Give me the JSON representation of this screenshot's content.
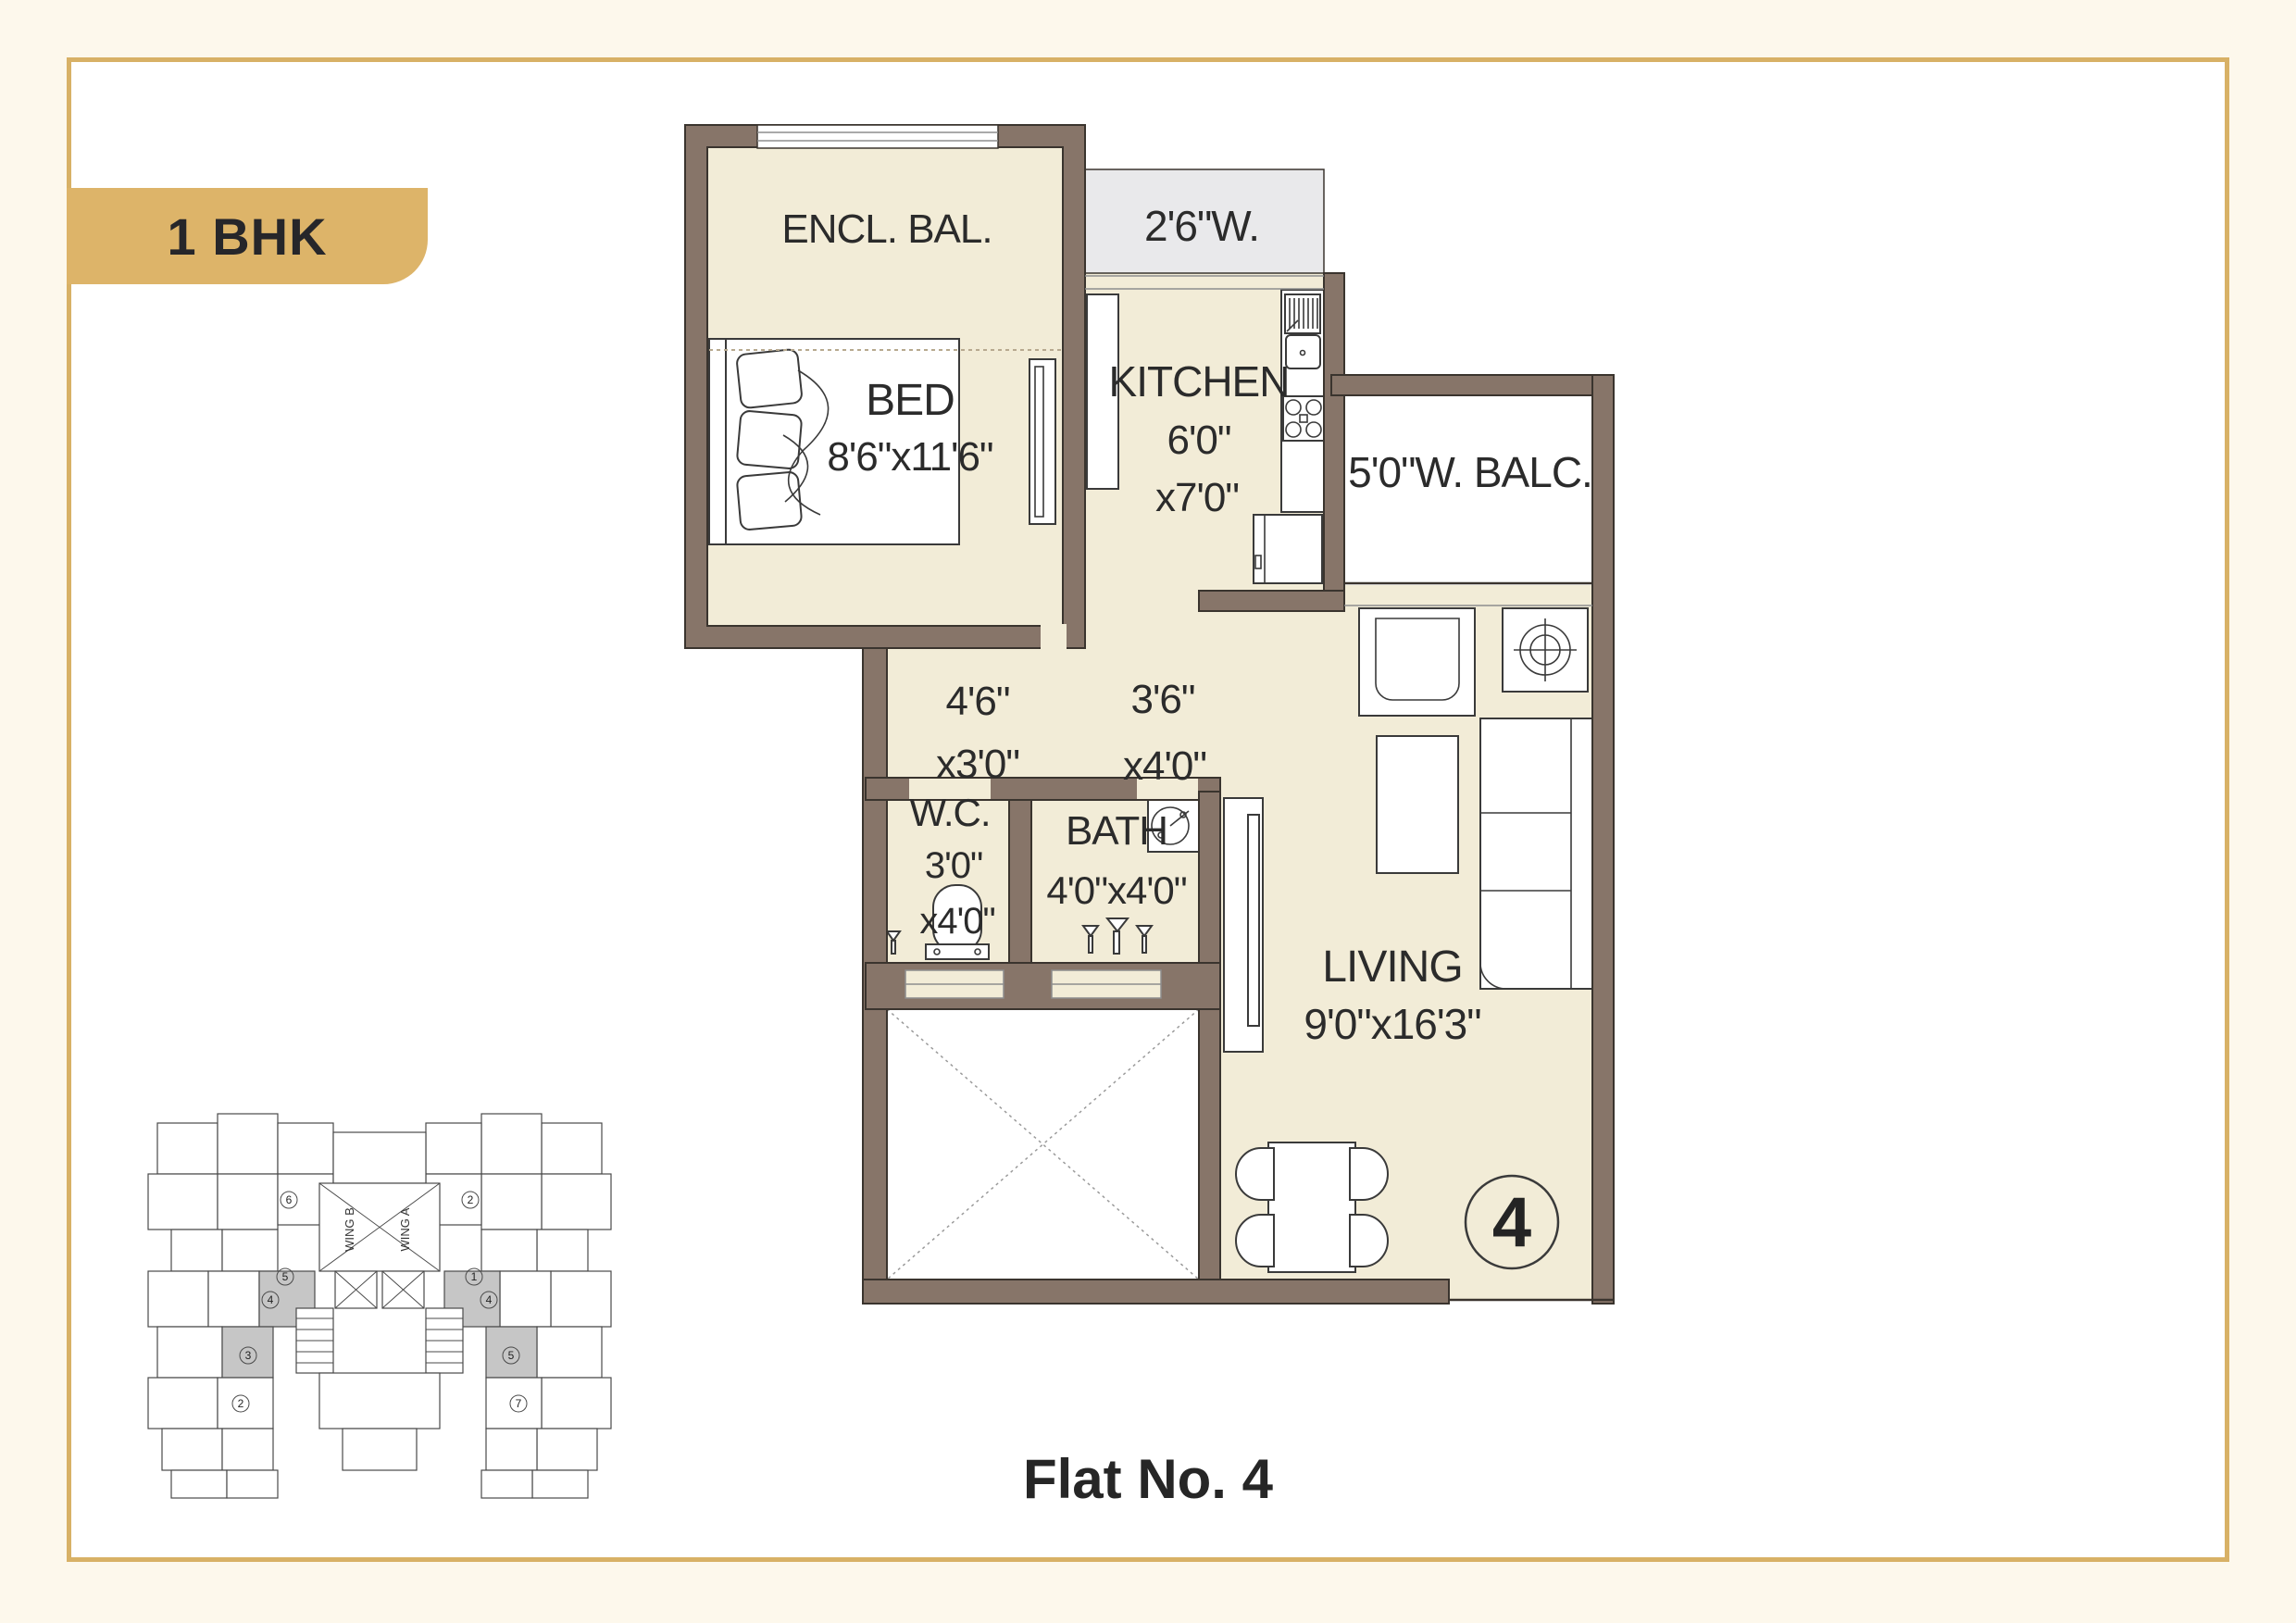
{
  "badge": {
    "label": "1 BHK"
  },
  "title": {
    "label": "Flat No. 4"
  },
  "colors": {
    "background": "#fdf8ec",
    "card_border": "#d8b166",
    "badge_bg": "#ddb469",
    "wall": "#877569",
    "wall_outline": "#3a342e",
    "floor": "#f2ecd7",
    "window_area_grey": "#e9e9eb",
    "text": "#2b2b2b",
    "furniture_line": "#3a3a3a"
  },
  "plan": {
    "encl_bal": {
      "label": "ENCL. BAL."
    },
    "bed": {
      "label": "BED",
      "dims": "8'6\"x11'6\""
    },
    "window": {
      "label": "2'6\"W."
    },
    "kitchen": {
      "label": "KITCHEN",
      "dim_line1": "6'0\"",
      "dim_line2": "x7'0\""
    },
    "balcony": {
      "label": "5'0\"W. BALC."
    },
    "passage1": {
      "dim_line1": "4'6\"",
      "dim_line2": "x3'0\""
    },
    "passage2": {
      "dim_line1": "3'6\"",
      "dim_line2": "x4'0\""
    },
    "wc": {
      "label": "W.C.",
      "dim_line1": "3'0\"",
      "dim_line2": "x4'0\""
    },
    "bath": {
      "label": "BATH",
      "dims": "4'0\"x4'0\""
    },
    "living": {
      "label": "LIVING",
      "dims": "9'0\"x16'3\""
    },
    "flat_number": "4"
  },
  "key_plan": {
    "wing_a": "WING A",
    "wing_b": "WING B",
    "circled_numbers": [
      "6",
      "5",
      "4",
      "3",
      "2",
      "2",
      "1",
      "4",
      "5",
      "7"
    ]
  }
}
